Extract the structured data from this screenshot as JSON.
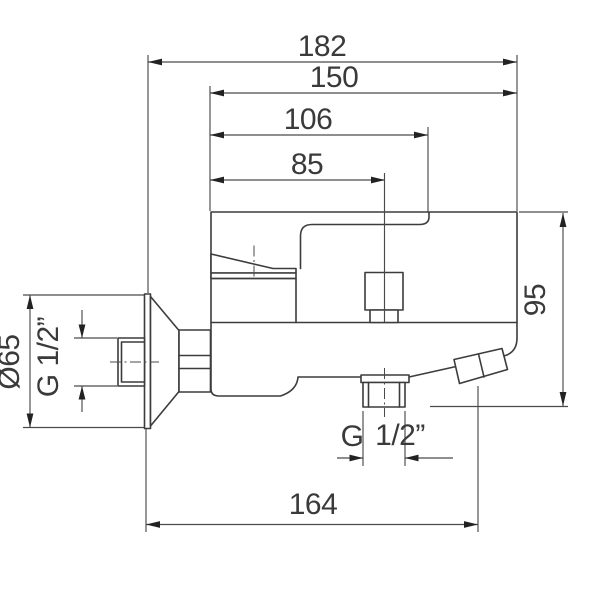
{
  "drawing": {
    "subject": "Wall-mounted single-lever bath shower mixer tap, side view technical dimension drawing",
    "background": "#ffffff",
    "line_color": "#3c3c3c",
    "dim_line_color": "#4a4a4a",
    "text_color": "#3a3a3a",
    "dims": {
      "overall_width": "182",
      "deck_width": "150",
      "lever_reach": "106",
      "shower_outlet_offset": "85",
      "height": "95",
      "wall_to_spout_outlet": "164",
      "flange_diameter": "Ø65",
      "wall_connection_thread": "G 1/2”",
      "bottom_outlet_thread_prefix": "G",
      "bottom_outlet_thread_size": "1/2”"
    }
  }
}
